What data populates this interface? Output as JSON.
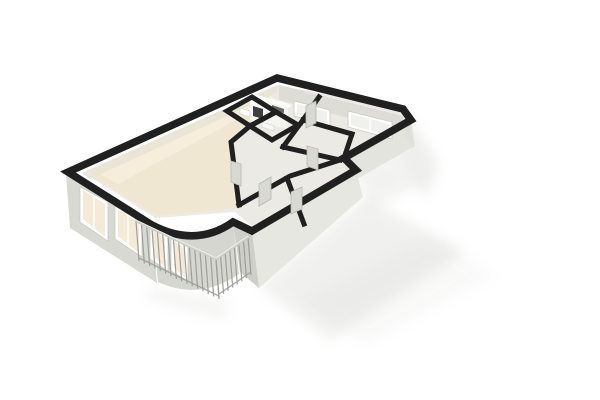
{
  "scene": {
    "type": "3d-floorplan-render",
    "canvas": {
      "width": 600,
      "height": 400,
      "background": "#ffffff"
    }
  },
  "palette": {
    "wall_band": "#202020",
    "shadow": "#c9c9c5",
    "face_bright": "#e7e7e1",
    "face_mid": "#d9d9d3",
    "face_dark": "#cfcfc9",
    "floor_gray": "#eceae5",
    "floor_cream": "#f0e7d3",
    "floor_cream_hi": "#f8efdc",
    "balcony_floor": "#f3f3ef",
    "window_frame": "#ffffff",
    "glass_warm": "#f4ead7",
    "glass_cool": "#f0f1ec",
    "door_panel": "#d9d9d4",
    "door_stroke": "#b7b7b1",
    "cabinet_front": "#fafaf8",
    "cabinet_top": "#ffffff",
    "appliance_dark": "#3f3f3f",
    "rail_top": "#cdcdc7",
    "rail_highlight": "#fafaf8",
    "rail_post": "#9f9f99"
  },
  "layers": {
    "shadows": [
      {
        "name": "shadow-east-wall",
        "points": "406,112 438,162 428,198 396,152",
        "opacity": 0.3
      },
      {
        "name": "shadow-step",
        "points": "352,174 392,150 424,184 372,208",
        "opacity": 0.22
      },
      {
        "name": "shadow-front",
        "points": "259,286 365,198 465,252 330,340",
        "opacity": 0.26
      },
      {
        "name": "shadow-front-fade",
        "points": "300,300 430,235 495,275 365,345",
        "opacity": 0.1
      },
      {
        "name": "shadow-balcony",
        "points": "148,286 230,302 224,320 150,300",
        "opacity": 0.18
      }
    ],
    "floors": [
      {
        "name": "interior-floor",
        "points": "277,85 84,173 155,218 235,212 254,228 356,168 344,157 411,119 403,109",
        "fill": "#eceae5"
      },
      {
        "name": "living-room-floor",
        "points": "276,88 250,126 228,142 236,208 157,216 88,174",
        "fill": "#f0e7d3"
      },
      {
        "name": "living-floor-highlight",
        "points": "272,92 100,174 118,184 273,100",
        "fill": "#f8efdc",
        "opacity": 0.8
      },
      {
        "name": "balcony-floor",
        "points": "138,220 216,258 247,237 233,222 196,244 152,225",
        "fill": "#f3f3ef"
      }
    ],
    "wall_faces": [
      {
        "name": "west-inner-wall-strip",
        "points": "277,85 82,173 90,179 277,93",
        "fill": "#ebe5d7"
      },
      {
        "name": "north-inner-wall",
        "points": "279,85 403,116 403,132 279,100",
        "fill": "#dddcd6"
      },
      {
        "name": "left-front-wall-outer",
        "points": "66,174 152,227 157,283 70,228",
        "fill": "#d9d9d3"
      },
      {
        "name": "curved-wall-face",
        "path": "M152,225 Q196,248 233,222 L239,274 Q200,301 158,282 Z",
        "fill": "#d6d6d0"
      },
      {
        "name": "front-wall-se-face",
        "points": "252,231 356,170 363,197 259,288",
        "fill": "#e7e7e1"
      },
      {
        "name": "front-wall-sw-face",
        "points": "233,222 252,231 259,288 240,272",
        "fill": "#cfcfc9"
      },
      {
        "name": "bedroom1-south-face",
        "points": "344,158 411,120 415,146 348,184",
        "fill": "#e4e4de"
      },
      {
        "name": "east-wall-face",
        "points": "403,109 411,121 414,148 406,136",
        "fill": "#e0e0da"
      }
    ],
    "windows": [
      {
        "name": "kitchen-window",
        "frame": "294,101 330,110 330,126 294,116",
        "glass": "297,104 327,112 327,123 297,114",
        "glass_fill": "glass_cool",
        "bar": "312,107 312,120"
      },
      {
        "name": "bedroom1-window",
        "frame": "348,111 392,122 392,139 348,127",
        "glass": "351,114 389,124 389,136 351,125",
        "glass_fill": "glass_cool",
        "bar": "370,118 370,131"
      },
      {
        "name": "living-window-1",
        "frame": "80,187 108,202 108,241 80,222",
        "glass": "83,190 105,204 105,237 83,219",
        "glass_fill": "glass_warm",
        "bar": "94,196 94,228"
      },
      {
        "name": "living-window-2",
        "frame": "115,206 142,221 142,257 115,239",
        "glass": "118,209 139,223 139,253 118,236",
        "glass_fill": "glass_warm",
        "bar": "128,215 128,245"
      },
      {
        "name": "balcony-door-1",
        "frame": "150,226 168,236 168,271 150,259",
        "glass": "153,229 165,238 165,267 153,256",
        "glass_fill": "glass_warm"
      },
      {
        "name": "balcony-door-2",
        "frame": "171,238 188,247 188,281 171,271",
        "glass": "174,241 185,249 185,277 174,268",
        "glass_fill": "glass_warm"
      }
    ],
    "furniture": [
      {
        "name": "kitchen-cabinet-front",
        "points": "250,97 266,102 266,126 250,120",
        "fill": "#fafaf8"
      },
      {
        "name": "kitchen-cabinet-top",
        "points": "250,97 266,102 270,99 254,94",
        "fill": "#ffffff"
      },
      {
        "name": "kitchen-oven",
        "points": "253,106 263,109 263,119 253,116",
        "fill": "#3f3f3f"
      },
      {
        "name": "kitchen-counter-front",
        "points": "266,102 288,108 288,129 266,124",
        "fill": "#f4f4f1"
      },
      {
        "name": "kitchen-counter-top",
        "points": "266,102 288,108 292,105 270,98",
        "fill": "#fdfdfc"
      },
      {
        "name": "kitchen-cooktop",
        "points": "272,105 284,109 284,113 272,110",
        "fill": "#3a3a3a",
        "opacity": 0.75
      },
      {
        "name": "bath-fixture-1",
        "points": "240,108 250,111 250,117 240,114",
        "fill": "#ffffff",
        "stroke": "#cfcfc9"
      },
      {
        "name": "bath-fixture-2",
        "points": "262,122 274,126 274,131 262,127",
        "fill": "#f8f8f6",
        "stroke": "#cfcfc9"
      }
    ],
    "interior_wall_bands": [
      {
        "name": "small-room-1-walls",
        "points": "252,97 227,111 250,126 276,112",
        "closed": true
      },
      {
        "name": "small-room-2-walls",
        "points": "276,112 250,126 272,140 298,125",
        "closed": true
      },
      {
        "name": "living-hall-wall",
        "points": "250,126 231,142 239,205"
      },
      {
        "name": "hall-front-wall",
        "points": "239,205 290,176 340,160"
      },
      {
        "name": "front-rooms-divider",
        "points": "287,178 304,224"
      },
      {
        "name": "bedroom1-west-wall",
        "points": "319,97 303,120"
      },
      {
        "name": "bedroom1-south-wall",
        "points": "303,120 352,134"
      },
      {
        "name": "step-wall",
        "points": "352,134 344,158"
      },
      {
        "name": "bedroom2-west-wall",
        "points": "303,120 283,147"
      },
      {
        "name": "bedroom2-south-wall",
        "points": "283,147 340,160"
      }
    ],
    "exterior_wall_band": {
      "name": "exterior-walls",
      "path": "M277,78 L68,172 L152,225 Q196,248 233,222 L252,231 L356,170 L344,158 L411,120 L403,109 Z",
      "width": 7.5
    },
    "doors": [
      {
        "name": "door-living-hall",
        "points": "231,161 241,164 241,186 231,182"
      },
      {
        "name": "door-hall-front",
        "points": "259,184 271,177 271,199 259,206"
      },
      {
        "name": "door-bedroom2",
        "points": "307,146 318,149 318,170 307,166"
      },
      {
        "name": "door-bedroom1",
        "points": "306,106 316,101 316,123 306,128"
      },
      {
        "name": "door-front-room",
        "points": "291,192 302,187 302,209 291,214"
      }
    ],
    "railing": {
      "runs": [
        {
          "name": "balcony-railing-front",
          "from": [
            136,
            221
          ],
          "to": [
            216,
            259
          ],
          "posts": 15,
          "drop": [
            3,
            40
          ]
        },
        {
          "name": "balcony-railing-side",
          "from": [
            216,
            259
          ],
          "to": [
            248,
            237
          ],
          "posts": 7,
          "drop": [
            3,
            38
          ]
        }
      ]
    }
  }
}
